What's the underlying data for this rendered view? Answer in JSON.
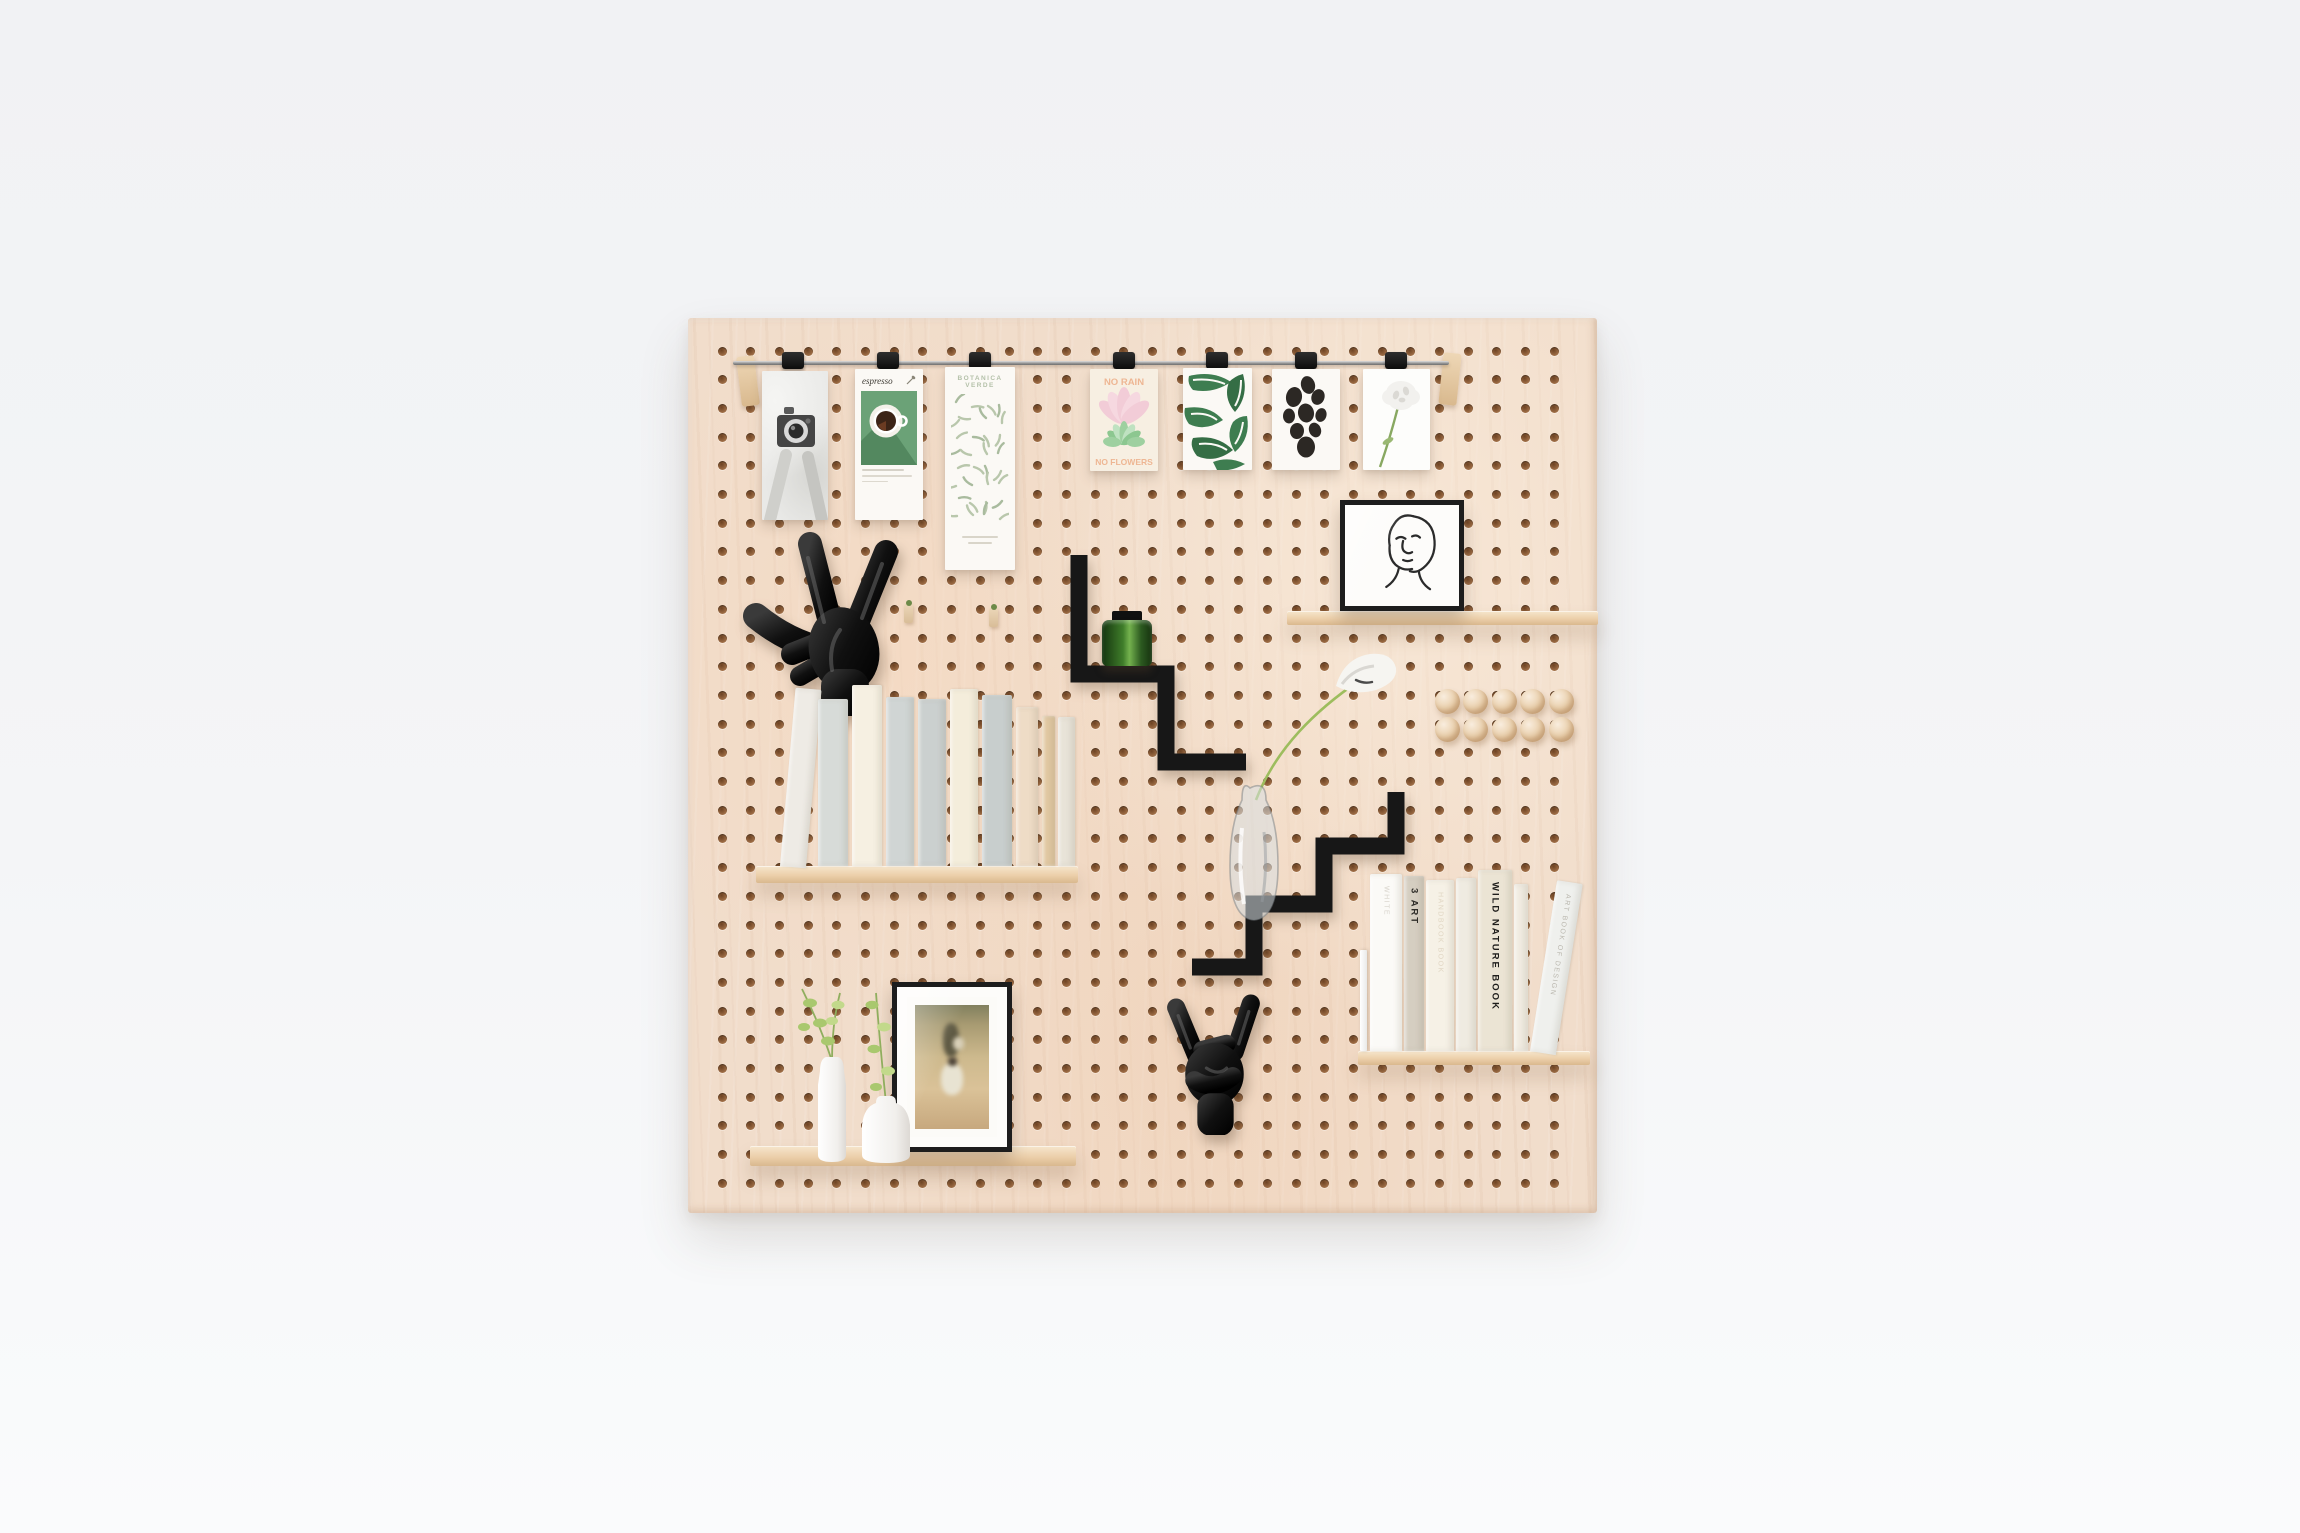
{
  "scene": {
    "description": "Birch plywood pegboard organizer styled with hanging art cards, black zigzag shelves, wooden shelves with books, black mannequin hands, vases and framed pictures on a light grey studio background",
    "colors": {
      "background": "#f4f5f7",
      "board_wood": "#f1ddcb",
      "hole_brown": "#9c6b44",
      "shelf_wood": "#eccfaa",
      "black_accent": "#151515",
      "card_white": "#fbf9f5",
      "espresso_green": "#6ba277",
      "leaf_green": "#3e7d50",
      "pastel_pink": "#f2ccd7",
      "pastel_peach": "#eeb693",
      "pastel_green": "#9ed0a0",
      "jar_green": "#3f7d2a",
      "stem_green": "#9dbd5e",
      "metal_rail": "#979797"
    },
    "holes": {
      "cols": 30,
      "rows": 30,
      "pitch": 28.7,
      "x0": 34,
      "y0": 33,
      "size": 9
    },
    "rail": {
      "clip_centers": [
        793,
        888,
        980,
        1124,
        1217,
        1306,
        1396
      ],
      "brackets": [
        {
          "x": 739,
          "y": 356,
          "h": 50,
          "rot": -7
        },
        {
          "x": 1441,
          "y": 353,
          "h": 52,
          "rot": 6
        }
      ]
    },
    "cards": [
      {
        "id": "camera",
        "name": "black-and-white vintage camera photo card"
      },
      {
        "id": "espresso",
        "title": "espresso",
        "name": "espresso coffee poster card"
      },
      {
        "id": "botanica",
        "title": "BOTANICA VERDE",
        "name": "sage leaf pattern poster card"
      },
      {
        "id": "no-rain",
        "title_top": "NO RAIN",
        "title_bottom": "NO FLOWERS",
        "name": "retro flower quote card"
      },
      {
        "id": "leaves",
        "name": "green tropical leaves art card"
      },
      {
        "id": "pebbles",
        "name": "black organic pebble shapes art card"
      },
      {
        "id": "flower",
        "name": "white flower photo card"
      }
    ],
    "books_left": [
      {
        "x": 24,
        "w": 26,
        "h": 179,
        "c": "#eeebe5",
        "tilt": 5
      },
      {
        "x": 62,
        "w": 30,
        "h": 167,
        "c": "#d7dbd8"
      },
      {
        "x": 96,
        "w": 30,
        "h": 181,
        "c": "#f6f0e2"
      },
      {
        "x": 130,
        "w": 28,
        "h": 169,
        "c": "#d0d5d4"
      },
      {
        "x": 162,
        "w": 28,
        "h": 167,
        "c": "#cbd0cf"
      },
      {
        "x": 194,
        "w": 28,
        "h": 177,
        "c": "#f4eddb"
      },
      {
        "x": 226,
        "w": 30,
        "h": 171,
        "c": "#c8cecd"
      },
      {
        "x": 260,
        "w": 22,
        "h": 159,
        "c": "#eedcc6"
      },
      {
        "x": 286,
        "w": 13,
        "h": 150,
        "c": "#e2c9a3"
      },
      {
        "x": 302,
        "w": 17,
        "h": 149,
        "c": "#e8e3d8"
      }
    ],
    "books_right": [
      {
        "x": 12,
        "w": 32,
        "h": 177,
        "c": "#fbfaf7",
        "label": "WHITE",
        "lc": "#d8d4cc"
      },
      {
        "x": 46,
        "w": 20,
        "h": 175,
        "c": "#d5cec1",
        "label": "3  ART",
        "lc": "#2e2c28",
        "bold": true
      },
      {
        "x": 68,
        "w": 28,
        "h": 171,
        "c": "#f6f1e6",
        "label": "HANDBOOK BOOK",
        "lc": "#e0d6c3"
      },
      {
        "x": 98,
        "w": 20,
        "h": 173,
        "c": "#efebe1"
      },
      {
        "x": 120,
        "w": 34,
        "h": 181,
        "c": "#ebe4d4",
        "label": "WILD NATURE BOOK",
        "lc": "#1e1d1b",
        "bold": true
      },
      {
        "x": 156,
        "w": 14,
        "h": 167,
        "c": "#f1ece2"
      },
      {
        "x": 172,
        "w": 26,
        "h": 173,
        "c": "#eff0ed",
        "label": "ART BOOK OF DESIGN",
        "lc": "#bab7ae",
        "tilt": 9
      }
    ],
    "pegballs": {
      "rows": 2,
      "cols": 5,
      "x0": 1447,
      "y0": 701,
      "pitch": 28.5
    },
    "mini_pegs": [
      {
        "x": 904,
        "y": 603
      },
      {
        "x": 989,
        "y": 607
      }
    ]
  }
}
